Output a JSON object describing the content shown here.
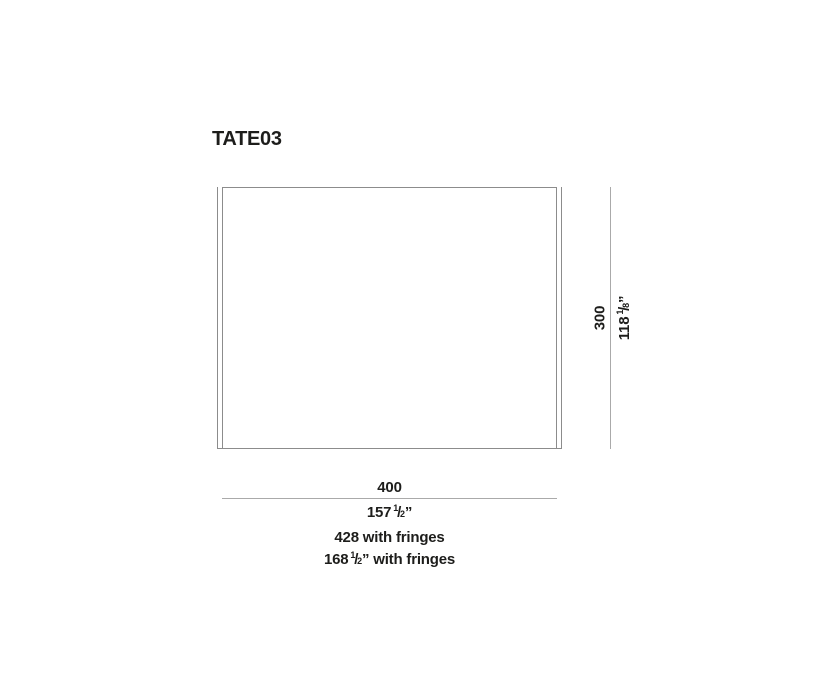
{
  "title": "TATE03",
  "colors": {
    "text": "#1d1d1b",
    "rug_line": "#8c8c8c",
    "dim_line": "#aaaaaa"
  },
  "diagram": {
    "frac_slash": "/",
    "height_dim": {
      "cm": "300",
      "in_main": "118",
      "in_num": "1",
      "in_den": "8",
      "in_mark": "”"
    },
    "width_dim": {
      "cm": "400",
      "in_main": "157",
      "in_num": "1",
      "in_den": "2",
      "in_mark": "”"
    },
    "fringe_dim": {
      "cm_text": "428 with fringes",
      "in_main": "168",
      "in_num": "1",
      "in_den": "2",
      "in_suffix": "” with fringes"
    }
  }
}
